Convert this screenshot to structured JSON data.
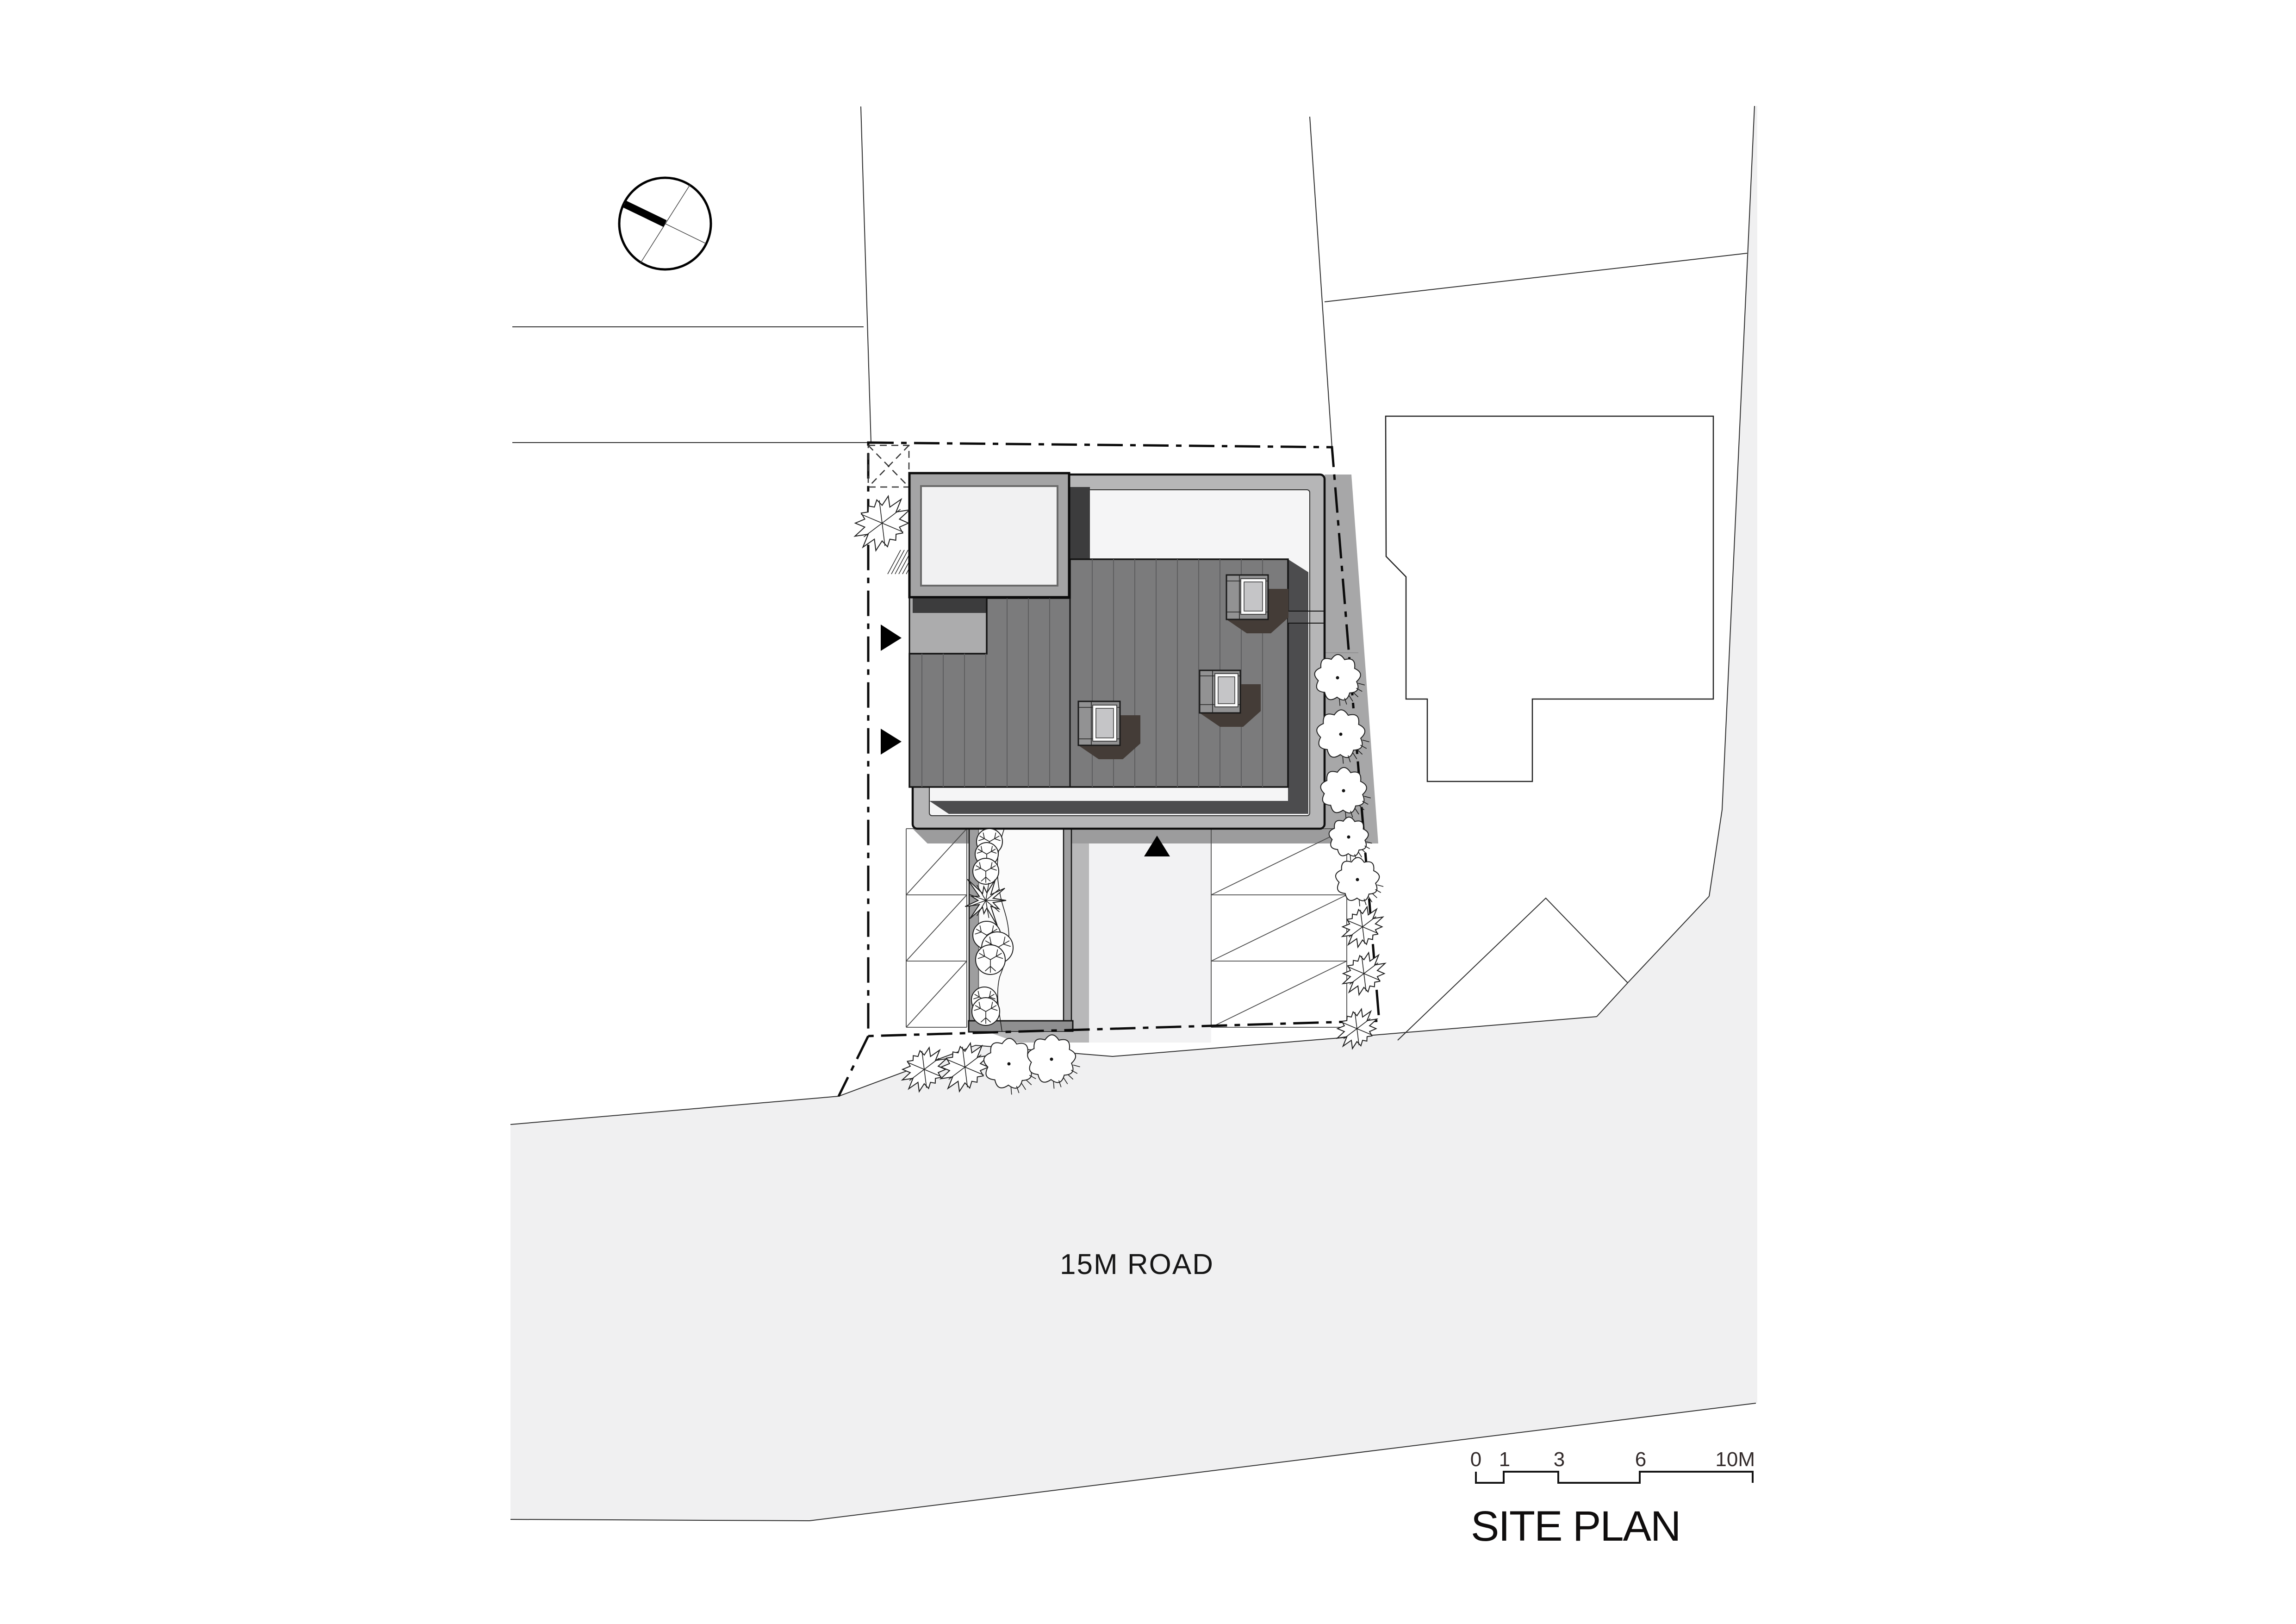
{
  "title": {
    "text": "SITE PLAN"
  },
  "road": {
    "label": "15M ROAD"
  },
  "scale_bar": {
    "labels": [
      "0",
      "1",
      "3",
      "6",
      "10M"
    ],
    "unit": "M"
  },
  "north": {
    "icon": "north-arrow"
  },
  "colors": {
    "road": "#f0f0f1",
    "band": "#b6b6b7",
    "terrace": "#f5f5f6",
    "roof": "#7b7b7c",
    "roof_shadow": "#4c4c4e",
    "garage_shadow": "#3c3c3d",
    "skylight_shadow": "#443c37",
    "skylight_box": "#929293",
    "glass": "#c5c5c7",
    "garage_fill": "#a4a4a5",
    "garage_inner": "#f1f1f2",
    "canopy": "#acacad",
    "side_yard": "#a7a7a8",
    "apron": "#9c9c9d",
    "wall": "#9e9e9f",
    "end_cap": "#8f8f90",
    "bed": "#fbfbfb",
    "wall_shadow": "#b8b8b9",
    "drive": "#f2f2f3",
    "ink_text": "#161616"
  }
}
